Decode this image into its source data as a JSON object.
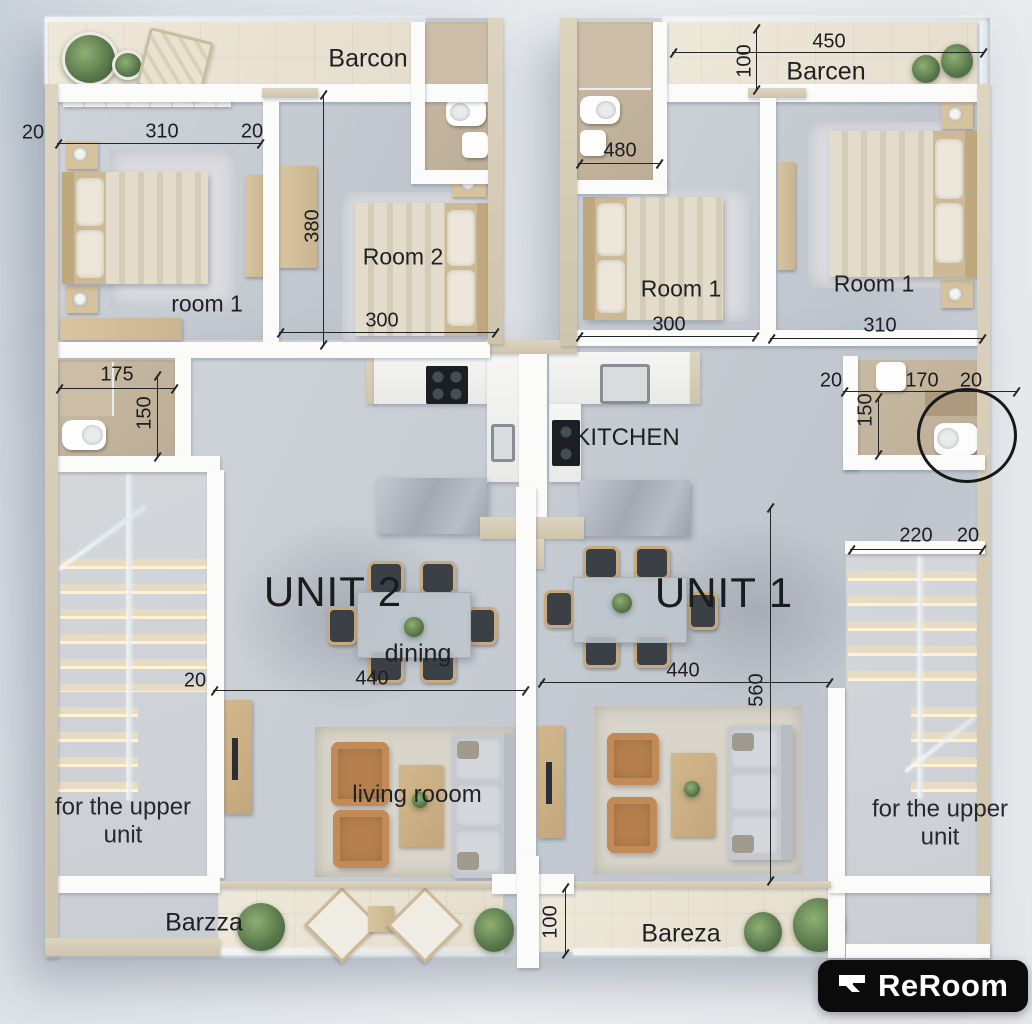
{
  "plan": {
    "type": "two-unit apartment floor plan",
    "units": {
      "unit2": "UNIT 2",
      "unit1": "UNIT 1"
    }
  },
  "labels": {
    "unit2": "UNIT 2",
    "unit1": "UNIT 1",
    "kitchen": "KITCHEN",
    "dining": "dining",
    "living": "living rooom",
    "u2_room1": "room 1",
    "u2_room2": "Room 2",
    "u1_room1_left": "Room 1",
    "u1_room1_right": "Room 1",
    "balcony_top_left": "Barcon",
    "balcony_top_right": "Barcen",
    "balcony_bottom_left": "Barzza",
    "balcony_bottom_right": "Bareza",
    "upper_left": "for the upper unit",
    "upper_right": "for the upper unit"
  },
  "dims": {
    "u2_left_wall": "20",
    "u2_room1_width": "310",
    "u2_mid_wall": "20",
    "u2_room2_height": "380",
    "u2_room2_width": "300",
    "u1_balcony_width": "450",
    "u1_balcony_depth": "100",
    "u1_bath_top_width": "480",
    "u1_room1_left_width": "300",
    "u1_room1_right_width": "310",
    "u2_bath_width": "175",
    "u2_bath_height": "150",
    "u1_bath_wall_left": "20",
    "u1_bath_width": "170",
    "u1_bath_wall_right": "20",
    "u1_bath_height": "150",
    "u2_living_wall": "20",
    "u2_living_width": "440",
    "u1_living_width": "440",
    "u1_living_height": "560",
    "right_stairs_width": "220",
    "right_stairs_wall": "20",
    "bottom_balcony_depth": "100"
  },
  "logo": {
    "brand": "ReRoom"
  },
  "colors": {
    "logo_bg": "#0b0b0c",
    "annotation": "#232629",
    "floor": "#c7ccd3",
    "balcony_tile": "#eae3d4",
    "bathroom_tile": "#c2b39b",
    "outer_wall": "#d5cab2",
    "leather": "#b5804e"
  }
}
